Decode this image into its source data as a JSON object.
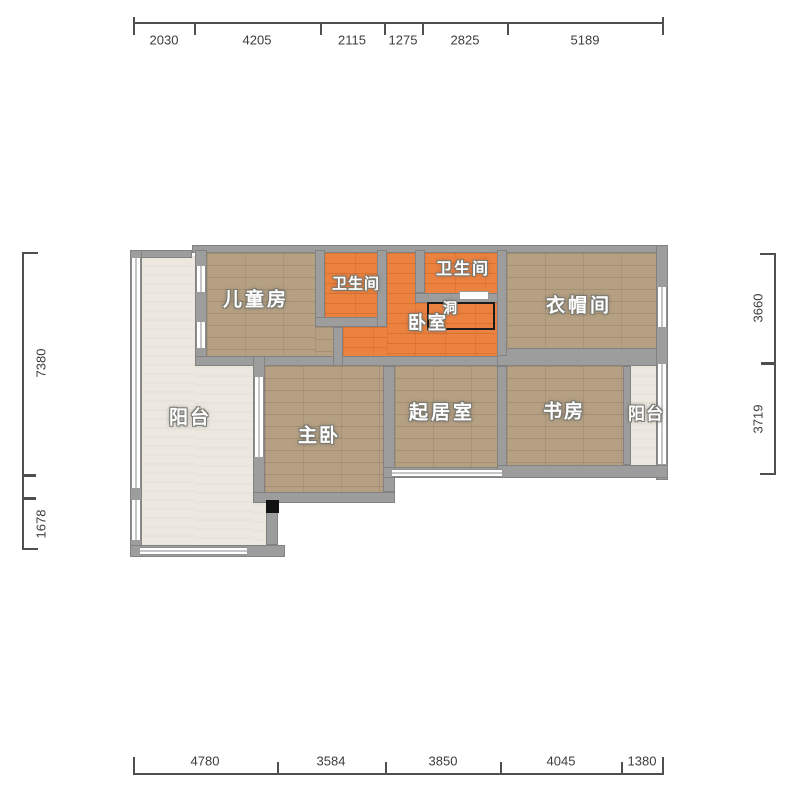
{
  "plan_type": "floor-plan",
  "rooms": {
    "children": "儿童房",
    "bath_left": "卫生间",
    "bath_right": "卫生间",
    "bedroom": "卧室",
    "hole": "洞",
    "cloakroom": "衣帽间",
    "balcony_left": "阳台",
    "master": "主卧",
    "living": "起居室",
    "study": "书房",
    "balcony_right": "阳台"
  },
  "dims": {
    "top": [
      "2030",
      "4205",
      "2115",
      "1275",
      "2825",
      "5189"
    ],
    "bottom": [
      "4780",
      "3584",
      "3850",
      "4045",
      "1380"
    ],
    "left": [
      "7380",
      "1678"
    ],
    "right": [
      "3660",
      "3719"
    ]
  },
  "colors": {
    "wall": "#9d9d9d",
    "wood_floor": "#b5a083",
    "orange_floor": "#ec8240",
    "balcony_floor": "#ece8df",
    "dimension_text": "#3c3c3c",
    "label_text": "#ffffff"
  }
}
